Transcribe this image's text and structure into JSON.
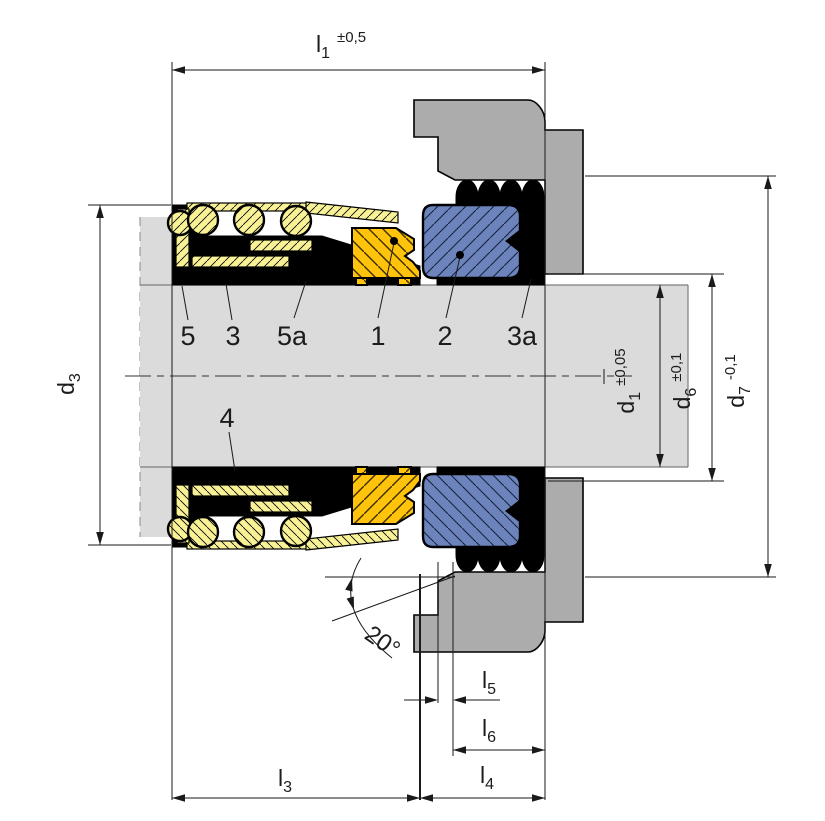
{
  "drawing": {
    "title": "mechanical-seal-cross-section",
    "dims": {
      "l1": {
        "name": "l",
        "sub": "1",
        "tol": "±0,5"
      },
      "l3": {
        "name": "l",
        "sub": "3"
      },
      "l4": {
        "name": "l",
        "sub": "4"
      },
      "l5": {
        "name": "l",
        "sub": "5"
      },
      "l6": {
        "name": "l",
        "sub": "6"
      },
      "d1": {
        "name": "d",
        "sub": "1",
        "tol": "±0,05"
      },
      "d3": {
        "name": "d",
        "sub": "3"
      },
      "d6": {
        "name": "d",
        "sub": "6",
        "tol": "±0,1"
      },
      "d7": {
        "name": "d",
        "sub": "7",
        "tol": "-0,1"
      },
      "angle": "20°"
    },
    "parts": {
      "p5": "5",
      "p3": "3",
      "p5a": "5a",
      "p1": "1",
      "p2": "2",
      "p3a": "3a",
      "p4": "4"
    },
    "colors": {
      "housing": "#ACACAC",
      "shaft": "#DBDBDB",
      "elastomer": "#000000",
      "spring-band": "#F8F195",
      "seal-face": "#FFC30B",
      "seat": "#6C83BC",
      "line": "#1a1a1a"
    }
  }
}
